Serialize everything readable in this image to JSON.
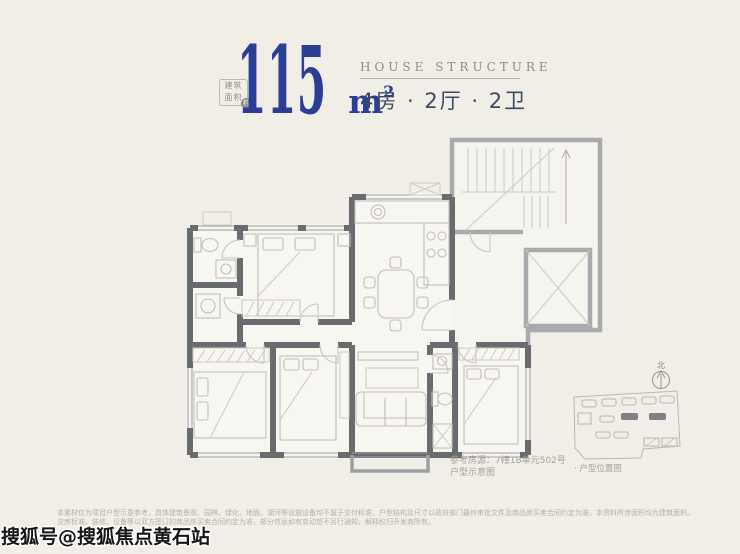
{
  "colors": {
    "background": "#f1ede7",
    "accent_blue": "#2b3e96",
    "wall_dark": "#686c6f",
    "wall_light": "#a8aaab",
    "text_slate": "#3d4a64"
  },
  "header": {
    "badge": {
      "line1": "建筑",
      "line2": "面积",
      "mark": "约"
    },
    "area_number": "115",
    "area_unit": "m",
    "area_sup": "2",
    "subtitle_en": "HOUSE STRUCTURE",
    "rooms_summary": "4房 · 2厅 · 2卫"
  },
  "floorplan": {
    "compass_north": "北",
    "caption_ref": "参考房源：7幢1B单元502号",
    "caption_note": "户型示意图",
    "minimap_label": "· 户型位置图"
  },
  "footer": {
    "disclaimer_line1": "本素材仅为项目户型示意参考，具体建筑景观、园林、绿化、地面、湖河等设施设备均不属于交付标准，户型结构及尺寸以政府部门最终审批文件及商品房买卖合同约定为准，本资料所涉面积均为建筑面积。",
    "disclaimer_line2": "交房标准、装修、设备等以双方签订的商品房买卖合同约定为准，部分信息如有变动恕不另行通知，解释权归开发商所有。",
    "watermark": "搜狐号@搜狐焦点黄石站"
  }
}
